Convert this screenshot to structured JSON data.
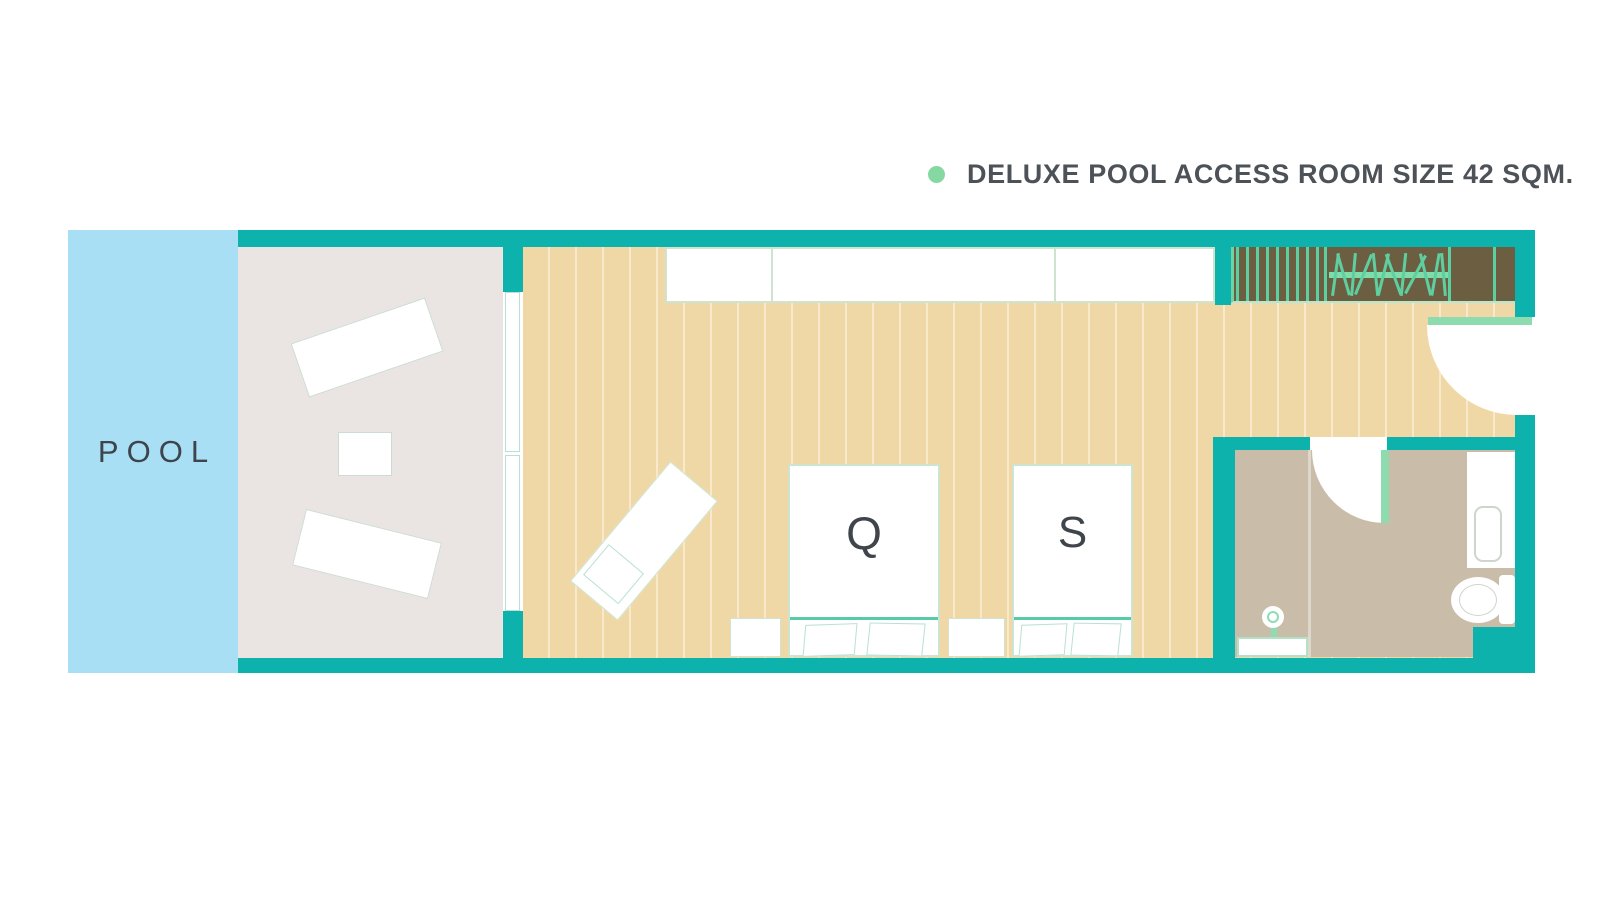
{
  "legend": {
    "label": "DELUXE POOL ACCESS ROOM SIZE 42 SQM.",
    "dot_color": "#85d8a2"
  },
  "pool": {
    "label": "POOL"
  },
  "beds": {
    "queen_label": "Q",
    "single_label": "S"
  },
  "rooms": {
    "pool": "pool",
    "terrace": "terrace with two sun loungers and side table",
    "bedroom": "wood-floor bedroom with queen bed, single bed, lounge chair, cabinets, wardrobe",
    "bathroom": "bathroom with shower, vanity sink, toilet"
  },
  "colors": {
    "wall_teal": "#0eb2ac",
    "pool_blue": "#a9dff5",
    "terrace_gray": "#eae5e2",
    "wood_floor": "#f0d8a6",
    "bath_floor": "#c9bda9",
    "closet_brown": "#6c5e41",
    "accent_green": "#8edbb0",
    "closet_green": "#5ecfa0",
    "headboard_green": "#57cba8",
    "legend_dot_green": "#85d8a2",
    "text_dark": "#4c5257"
  }
}
